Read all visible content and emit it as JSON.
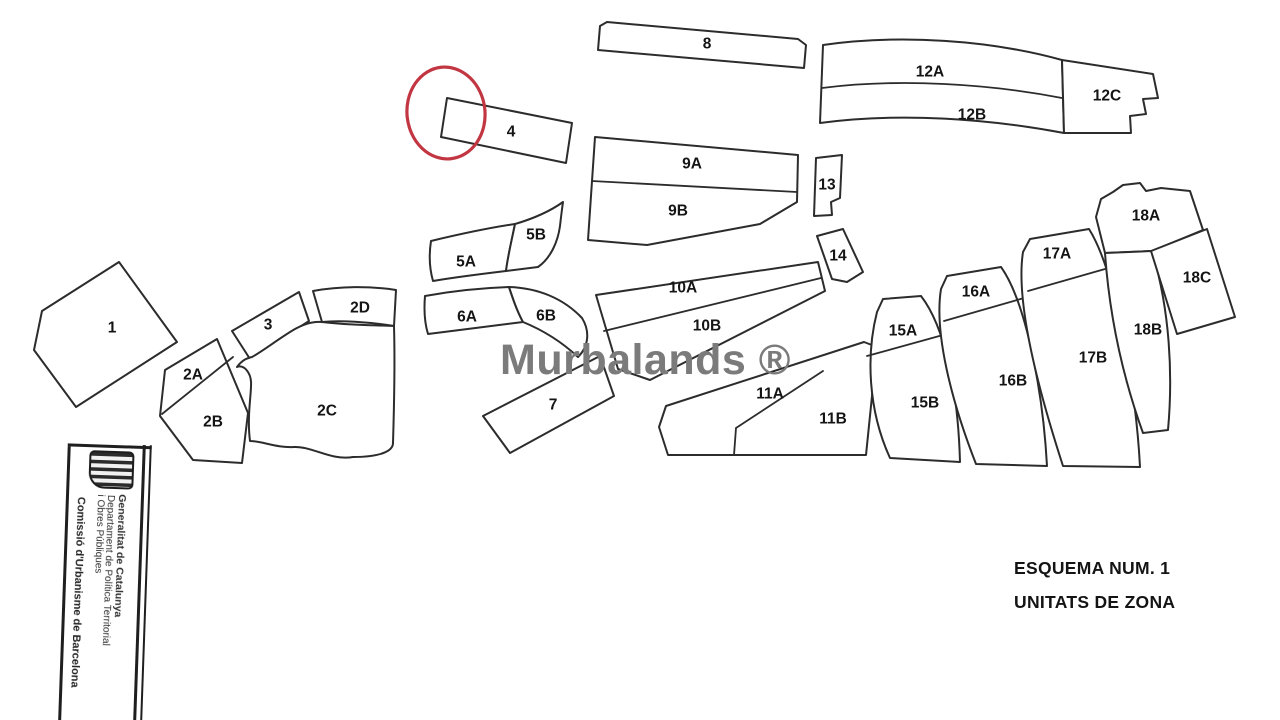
{
  "title_block": {
    "line1": "ESQUEMA NUM. 1",
    "line2": "UNITATS DE ZONA"
  },
  "watermark": {
    "text": "Murbalands ®",
    "color": "#7b7b7b"
  },
  "highlight": {
    "shape": "red-ellipse",
    "color": "#c23642",
    "marks_zone": "4"
  },
  "stamp": {
    "logo": "generalitat-senyera-shield",
    "org": "Generalitat de Catalunya",
    "dept1": "Departament de Política Territorial",
    "dept2": "i Obres Públiques",
    "commission": "Comissió d'Urbanisme de Barcelona"
  },
  "zones": [
    {
      "label": "1"
    },
    {
      "label": "2A"
    },
    {
      "label": "2B"
    },
    {
      "label": "2C"
    },
    {
      "label": "2D"
    },
    {
      "label": "3"
    },
    {
      "label": "4"
    },
    {
      "label": "5A"
    },
    {
      "label": "5B"
    },
    {
      "label": "6A"
    },
    {
      "label": "6B"
    },
    {
      "label": "7"
    },
    {
      "label": "8"
    },
    {
      "label": "9A"
    },
    {
      "label": "9B"
    },
    {
      "label": "10A"
    },
    {
      "label": "10B"
    },
    {
      "label": "11A"
    },
    {
      "label": "11B"
    },
    {
      "label": "12A"
    },
    {
      "label": "12B"
    },
    {
      "label": "12C"
    },
    {
      "label": "13"
    },
    {
      "label": "14"
    },
    {
      "label": "15A"
    },
    {
      "label": "15B"
    },
    {
      "label": "16A"
    },
    {
      "label": "16B"
    },
    {
      "label": "17A"
    },
    {
      "label": "17B"
    },
    {
      "label": "18A"
    },
    {
      "label": "18B"
    },
    {
      "label": "18C"
    }
  ]
}
